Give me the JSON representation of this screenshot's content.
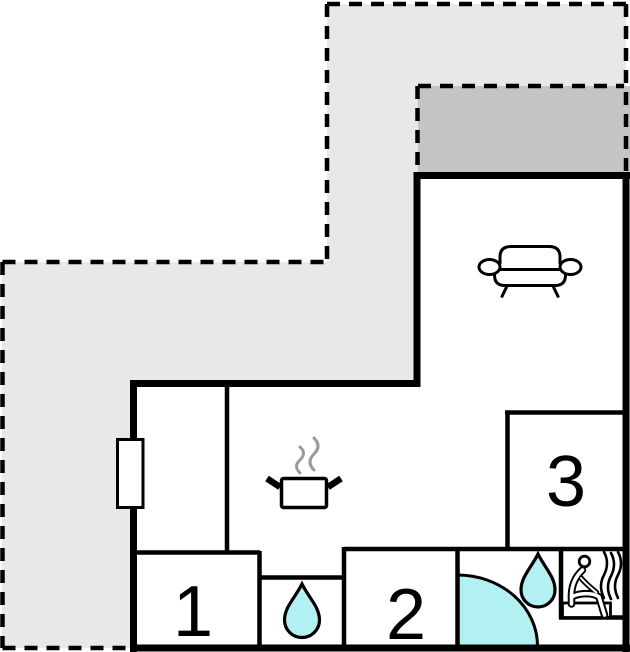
{
  "rooms": [
    {
      "id": "room-1",
      "label": "1"
    },
    {
      "id": "room-2",
      "label": "2"
    },
    {
      "id": "room-3",
      "label": "3"
    }
  ],
  "colors": {
    "background": "#ffffff",
    "terrace": "#e8e8e8",
    "balcony": "#c4c4c4",
    "water": "#b3f0f2",
    "wall": "#000000",
    "steam": "#9a9a9a"
  },
  "icons": [
    "couch-icon",
    "cooking-pot-icon",
    "pot-steam-icon",
    "window-marker-icon",
    "water-drop-icon-wc",
    "water-drop-icon-bathroom",
    "shower-icon",
    "sauna-person-icon",
    "sauna-steam-icon"
  ]
}
